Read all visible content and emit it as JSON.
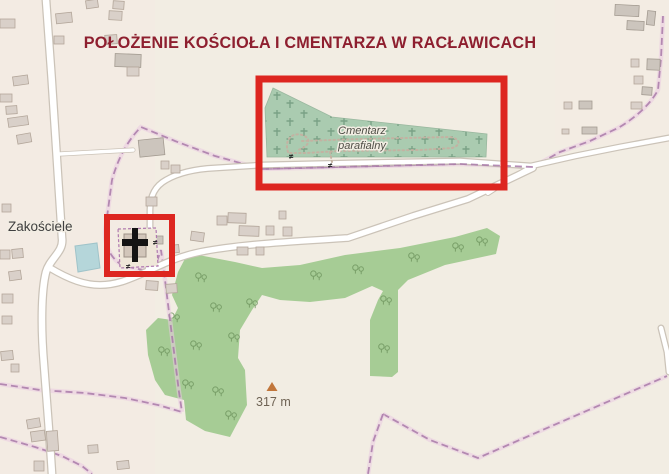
{
  "title": {
    "text": "POŁOŻENIE KOŚCIOŁA I CMENTARZA W RACŁAWICACH",
    "color": "#8e1f2f"
  },
  "map": {
    "labels": {
      "place": "Zakościele",
      "cemetery_line1": "Cmentarz",
      "cemetery_line2": "parafialny",
      "peak_elevation": "317 m",
      "gate_symbol": "≠"
    },
    "icons": {
      "peak": "triangle-peak-icon",
      "church": "christian-cross-icon",
      "cemetery_pattern": "cross-grave-pattern",
      "trees": "deciduous-tree-icon",
      "gate": "gate-icon"
    },
    "colors": {
      "background": "#f2ede3",
      "forest": "#a6cc95",
      "cemetery": "#aacbb0",
      "water": "#b5d6da",
      "building_fill": "#d9d0c9",
      "road_fill": "#ffffff",
      "road_casing": "#cbc3b8",
      "boundary": "#a879a8",
      "annotation_red": "#dd2620",
      "peak_marker": "#c1763b"
    },
    "annotations": {
      "cemetery_box": "cemetery highlight rectangle",
      "church_box": "church highlight rectangle"
    }
  }
}
